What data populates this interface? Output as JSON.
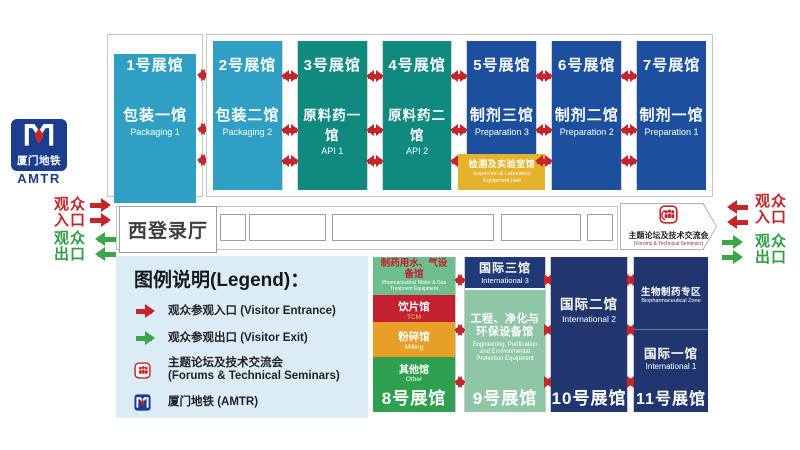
{
  "halls_top": [
    {
      "number": "1号展馆",
      "name_cn": "包装一馆",
      "name_en": "Packaging 1"
    },
    {
      "number": "2号展馆",
      "name_cn": "包装二馆",
      "name_en": "Packaging 2"
    },
    {
      "number": "3号展馆",
      "name_cn": "原料药一馆",
      "name_en": "API 1"
    },
    {
      "number": "4号展馆",
      "name_cn": "原料药二馆",
      "name_en": "API 2"
    },
    {
      "number": "5号展馆",
      "name_cn": "制剂三馆",
      "name_en": "Preparation 3"
    },
    {
      "number": "6号展馆",
      "name_cn": "制剂二馆",
      "name_en": "Preparation 2"
    },
    {
      "number": "7号展馆",
      "name_cn": "制剂一馆",
      "name_en": "Preparation 1"
    }
  ],
  "inspection_hall": {
    "name_cn": "检测及实验室馆",
    "name_en": "Inspection & Laboratory Equipment Hall"
  },
  "west_registration_hall": "西登录厅",
  "forum_seminars": {
    "name_cn": "主题论坛及技术交流会",
    "name_en": "(Forums & Technical Seminars)"
  },
  "metro": {
    "name_cn": "厦门地铁",
    "abbr": "AMTR"
  },
  "visitor_entrance": {
    "line1": "观众",
    "line2": "入口"
  },
  "visitor_exit": {
    "line1": "观众",
    "line2": "出口"
  },
  "legend": {
    "title": "图例说明(Legend)：",
    "entrance": "观众参观入口 (Visitor Entrance)",
    "exit": "观众参观出口 (Visitor Exit)",
    "forum_cn": "主题论坛及技术交流会",
    "forum_en": "(Forums & Technical Seminars)",
    "metro": "厦门地铁 (AMTR)"
  },
  "hall8": {
    "number": "8号展馆",
    "sections": [
      {
        "name_cn": "制药用水、气设备馆",
        "name_en": "Pharmaceutical Water & Gas Treatment Equipment"
      },
      {
        "name_cn": "饮片馆",
        "name_en": "TCM"
      },
      {
        "name_cn": "粉碎馆",
        "name_en": "Milling"
      },
      {
        "name_cn": "其他馆",
        "name_en": "Other"
      }
    ]
  },
  "hall9": {
    "number": "9号展馆",
    "intl_cn": "国际三馆",
    "intl_en": "International 3",
    "eng_cn": "工程、净化与环保设备馆",
    "eng_en": "Engineering, Purification and Environmental Protection Equipment"
  },
  "hall10": {
    "number": "10号展馆",
    "name_cn": "国际二馆",
    "name_en": "International 2"
  },
  "hall11": {
    "number": "11号展馆",
    "zone_cn": "生物制药专区",
    "zone_en": "Biopharmaceutical Zone",
    "name_cn": "国际一馆",
    "name_en": "International 1"
  },
  "colors": {
    "packaging_halls": "#2f9fc4",
    "api_halls": "#10897f",
    "preparation_halls": "#1c4f9e",
    "international_halls": "#21366f",
    "inspection_hall": "#e4b22b",
    "entrance_red": "#c5262c",
    "exit_green": "#3aa647",
    "legend_bg": "#dbecf6",
    "metro_blue": "#1b3c8f"
  },
  "icons": {
    "entrance": "red-right-arrow",
    "exit": "green-left-arrow",
    "forum": "forum-people-icon",
    "metro": "metro-m-icon",
    "transfer": "red-double-arrow"
  }
}
